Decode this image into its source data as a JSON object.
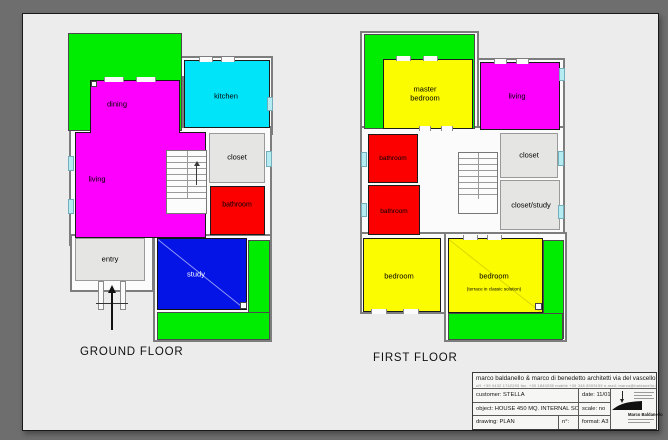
{
  "colors": {
    "green": "#00ec00",
    "magenta": "#fd00fd",
    "cyan": "#00e4fa",
    "red": "#fc0000",
    "yellow": "#fcfc00",
    "blue": "#0414e6",
    "room_gray": "#e5e5e3",
    "wall_fill": "#fbfbfb",
    "window": "#b5ecf1",
    "sheet": "#ececec",
    "frame": "#6e6e6e"
  },
  "plans": [
    {
      "id": "ground-floor-plan",
      "label": "GROUND FLOOR",
      "label_x": 80,
      "label_y": 346,
      "walls": [
        [
          180,
          56,
          93,
          79
        ],
        [
          86,
          76,
          98,
          62
        ],
        [
          69,
          126,
          203,
          120
        ],
        [
          70,
          234,
          84,
          58
        ],
        [
          153,
          234,
          119,
          108
        ]
      ],
      "greens": [
        [
          68,
          33,
          114,
          98
        ],
        [
          248,
          240,
          22,
          99
        ],
        [
          157,
          312,
          113,
          28
        ]
      ],
      "rooms": [
        {
          "key": "dining",
          "rect": [
            90,
            80,
            90,
            58
          ],
          "color": "magenta",
          "border": "#1a1a1a",
          "label": "dining",
          "lx": 117,
          "ly": 104,
          "fs": 7.5
        },
        {
          "key": "living",
          "rect": [
            75,
            132,
            131,
            106
          ],
          "color": "magenta",
          "border": "#1a1a1a",
          "label": "living",
          "lx": 97,
          "ly": 179,
          "fs": 7.5
        },
        {
          "key": "dining-living-join",
          "rect": [
            91,
            125,
            88,
            14
          ],
          "color": "magenta"
        },
        {
          "key": "kitchen",
          "rect": [
            184,
            60,
            86,
            68
          ],
          "color": "cyan",
          "border": "#1a1a1a",
          "label": "kitchen",
          "lx": 226,
          "ly": 96,
          "fs": 7.5
        },
        {
          "key": "closet",
          "rect": [
            209,
            133,
            56,
            50
          ],
          "color": "room_gray",
          "border": "#999999",
          "label": "closet",
          "lx": 237,
          "ly": 157,
          "fs": 7.5
        },
        {
          "key": "bathroom",
          "rect": [
            210,
            186,
            55,
            49
          ],
          "color": "red",
          "border": "#1a1a1a",
          "label": "bathroom",
          "lx": 237,
          "ly": 206,
          "fs": 7
        },
        {
          "key": "entry",
          "rect": [
            75,
            238,
            70,
            43
          ],
          "color": "room_gray",
          "border": "#999999",
          "label": "entry",
          "lx": 110,
          "ly": 259,
          "fs": 7.5
        },
        {
          "key": "study",
          "rect": [
            157,
            238,
            90,
            72
          ],
          "color": "blue",
          "border": "#111111",
          "label": "study",
          "tc": "#ffffff",
          "lx": 196,
          "ly": 274,
          "fs": 7.5,
          "diag": "light"
        }
      ],
      "stairs": {
        "rect": [
          166,
          150,
          41,
          64
        ],
        "landing": 14,
        "arrow": true
      },
      "gaps": [
        [
          104,
          77,
          20,
          5
        ],
        [
          136,
          77,
          20,
          5
        ],
        [
          199,
          57,
          14,
          5
        ],
        [
          221,
          57,
          14,
          5
        ]
      ],
      "windows": [
        [
          68,
          156,
          6,
          15
        ],
        [
          68,
          199,
          6,
          15
        ],
        [
          266,
          151,
          6,
          16
        ],
        [
          267,
          97,
          6,
          14
        ]
      ],
      "squares": [
        [
          91,
          81,
          6,
          6
        ],
        [
          240,
          302,
          7,
          7
        ]
      ],
      "porch": {
        "x": 98,
        "y": 281,
        "w": 28,
        "h": 29
      },
      "arrow": {
        "x": 111,
        "y1": 285,
        "y2": 330
      }
    },
    {
      "id": "first-floor-plan",
      "label": "FIRST FLOOR",
      "label_x": 373,
      "label_y": 352,
      "walls": [
        [
          360,
          31,
          119,
          104
        ],
        [
          477,
          58,
          88,
          78
        ],
        [
          360,
          126,
          205,
          112
        ],
        [
          360,
          232,
          88,
          82
        ],
        [
          444,
          232,
          123,
          110
        ]
      ],
      "greens": [
        [
          364,
          34,
          111,
          95
        ],
        [
          543,
          240,
          21,
          99
        ],
        [
          448,
          313,
          115,
          27
        ]
      ],
      "rooms": [
        {
          "key": "master-bedroom",
          "rect": [
            383,
            59,
            90,
            70
          ],
          "color": "yellow",
          "border": "#1a1a1a",
          "label": "master\nbedroom",
          "lx": 425,
          "ly": 94,
          "fs": 7.5
        },
        {
          "key": "living",
          "rect": [
            480,
            62,
            80,
            68
          ],
          "color": "magenta",
          "border": "#1a1a1a",
          "label": "living",
          "lx": 517,
          "ly": 96,
          "fs": 7.5
        },
        {
          "key": "bathroom-upper",
          "rect": [
            368,
            134,
            50,
            49
          ],
          "color": "red",
          "border": "#1a1a1a",
          "label": "bathroom",
          "lx": 393,
          "ly": 159,
          "fs": 6.5
        },
        {
          "key": "bathroom-lower",
          "rect": [
            368,
            185,
            52,
            50
          ],
          "color": "red",
          "border": "#1a1a1a",
          "label": "bathroom",
          "lx": 394,
          "ly": 212,
          "fs": 6.5
        },
        {
          "key": "closet",
          "rect": [
            500,
            133,
            58,
            45
          ],
          "color": "room_gray",
          "border": "#999999",
          "label": "closet",
          "lx": 529,
          "ly": 155,
          "fs": 7.5
        },
        {
          "key": "closet-study",
          "rect": [
            500,
            180,
            60,
            50
          ],
          "color": "room_gray",
          "border": "#999999",
          "label": "closet/study",
          "lx": 531,
          "ly": 205,
          "fs": 7.5
        },
        {
          "key": "bedroom-left",
          "rect": [
            363,
            238,
            78,
            74
          ],
          "color": "yellow",
          "border": "#1a1a1a",
          "label": "bedroom",
          "lx": 399,
          "ly": 276,
          "fs": 7.5
        },
        {
          "key": "bedroom-right",
          "rect": [
            448,
            238,
            95,
            75
          ],
          "color": "yellow",
          "border": "#1a1a1a",
          "label": "bedroom",
          "lx": 494,
          "ly": 276,
          "fs": 7.5,
          "sub": "(terrace in classic solution)",
          "sx": 494,
          "sy": 289,
          "sfs": 4.6,
          "diag": "dark"
        }
      ],
      "stairs": {
        "rect": [
          458,
          152,
          40,
          62
        ],
        "landing": 14,
        "arrow": false
      },
      "gaps": [
        [
          396,
          56,
          15,
          5
        ],
        [
          423,
          56,
          15,
          5
        ],
        [
          494,
          59,
          13,
          5
        ],
        [
          516,
          59,
          13,
          5
        ],
        [
          419,
          126,
          12,
          5
        ],
        [
          441,
          126,
          12,
          5
        ],
        [
          371,
          309,
          16,
          5
        ],
        [
          403,
          309,
          16,
          5
        ],
        [
          463,
          235,
          15,
          5
        ],
        [
          487,
          235,
          15,
          5
        ]
      ],
      "windows": [
        [
          361,
          152,
          6,
          15
        ],
        [
          361,
          203,
          6,
          14
        ],
        [
          558,
          151,
          6,
          15
        ],
        [
          558,
          205,
          6,
          14
        ],
        [
          559,
          68,
          6,
          13
        ]
      ],
      "squares": [
        [
          535,
          303,
          7,
          7
        ]
      ]
    }
  ],
  "title_block": {
    "architects": "marco baldanello & marco di benedetto architetti via del vascello 3 33100 udine",
    "contact": "uff. +39 0432 1742293 fax. +39 1840035 mobile +39 348 8009159 e-mail: marco@baldanello.it",
    "customer": "customer:  STELLA",
    "date": "date:  11/01/11",
    "object": "object: HOUSE 450 MQ. INTERNAL SOLUTION",
    "scale": "scale:  no",
    "drawing": "drawing:  PLAN",
    "number": "n°:",
    "format": "format:  A3",
    "logo_name": "Marco Baldanello"
  }
}
